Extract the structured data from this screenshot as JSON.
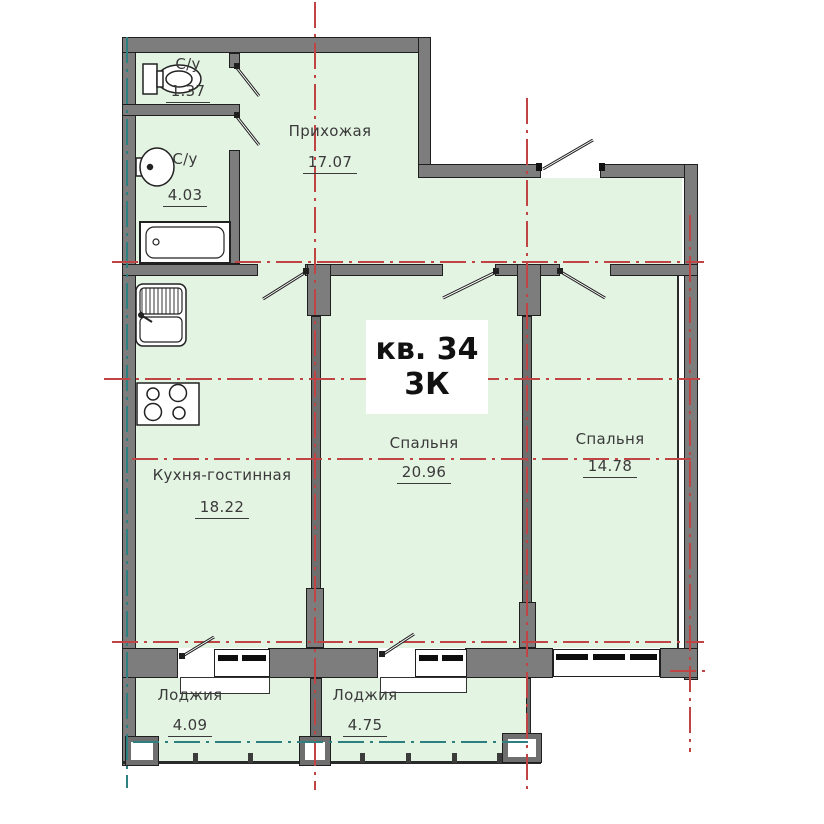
{
  "title": {
    "apartment": "кв. 34",
    "rooms_type": "3К"
  },
  "rooms": [
    {
      "name": "С/у",
      "area": "1.37"
    },
    {
      "name": "С/у",
      "area": "4.03"
    },
    {
      "name": "Прихожая",
      "area": "17.07"
    },
    {
      "name": "Кухня-гостинная",
      "area": "18.22"
    },
    {
      "name": "Спальня",
      "area": "20.96"
    },
    {
      "name": "Спальня",
      "area": "14.78"
    },
    {
      "name": "Лоджия",
      "area": "4.09"
    },
    {
      "name": "Лоджия",
      "area": "4.75"
    }
  ],
  "colors": {
    "room_fill": "#e4f4e3",
    "wall": "#7d7d7d",
    "outline": "#1f1f1f",
    "axis_red": "#c14444",
    "axis_teal": "#2e7f7f",
    "text": "#3a3a3a"
  },
  "icons": {
    "fixtures": [
      "toilet-icon",
      "washbasin-icon",
      "bathtub-icon",
      "kitchen-sink-icon",
      "stove-icon"
    ],
    "openings": [
      "door-leaf-icon",
      "window-glazing-icon"
    ]
  }
}
